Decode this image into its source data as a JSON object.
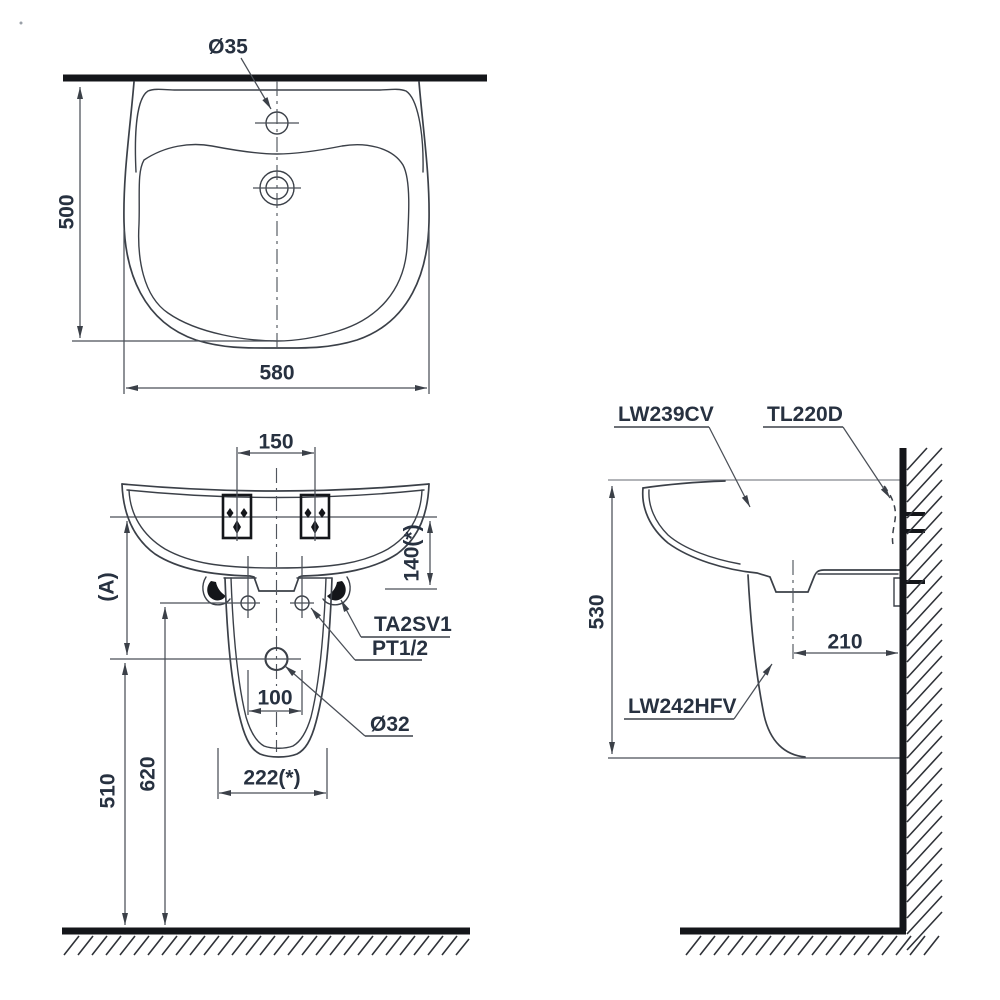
{
  "colors": {
    "line": "#3b4048",
    "dim": "#4a4f57",
    "heavy": "#14161a",
    "text": "#273140"
  },
  "top_view": {
    "faucet_hole": "Ø35",
    "depth": "500",
    "width": "580"
  },
  "front_view": {
    "faucet_centers": "150",
    "rim_to_drain": "140(*)",
    "ref_height": "(A)",
    "bracket_code": "TA2SV1",
    "thread_code": "PT1/2",
    "bolt_pitch": "100",
    "drain_dia": "Ø32",
    "bolt_height": "620",
    "drain_height": "510",
    "pedestal_width": "222(*)"
  },
  "side_view": {
    "basin_code": "LW239CV",
    "valve_code": "TL220D",
    "pedestal_code": "LW242HFV",
    "rim_height": "530",
    "drain_offset": "210"
  }
}
